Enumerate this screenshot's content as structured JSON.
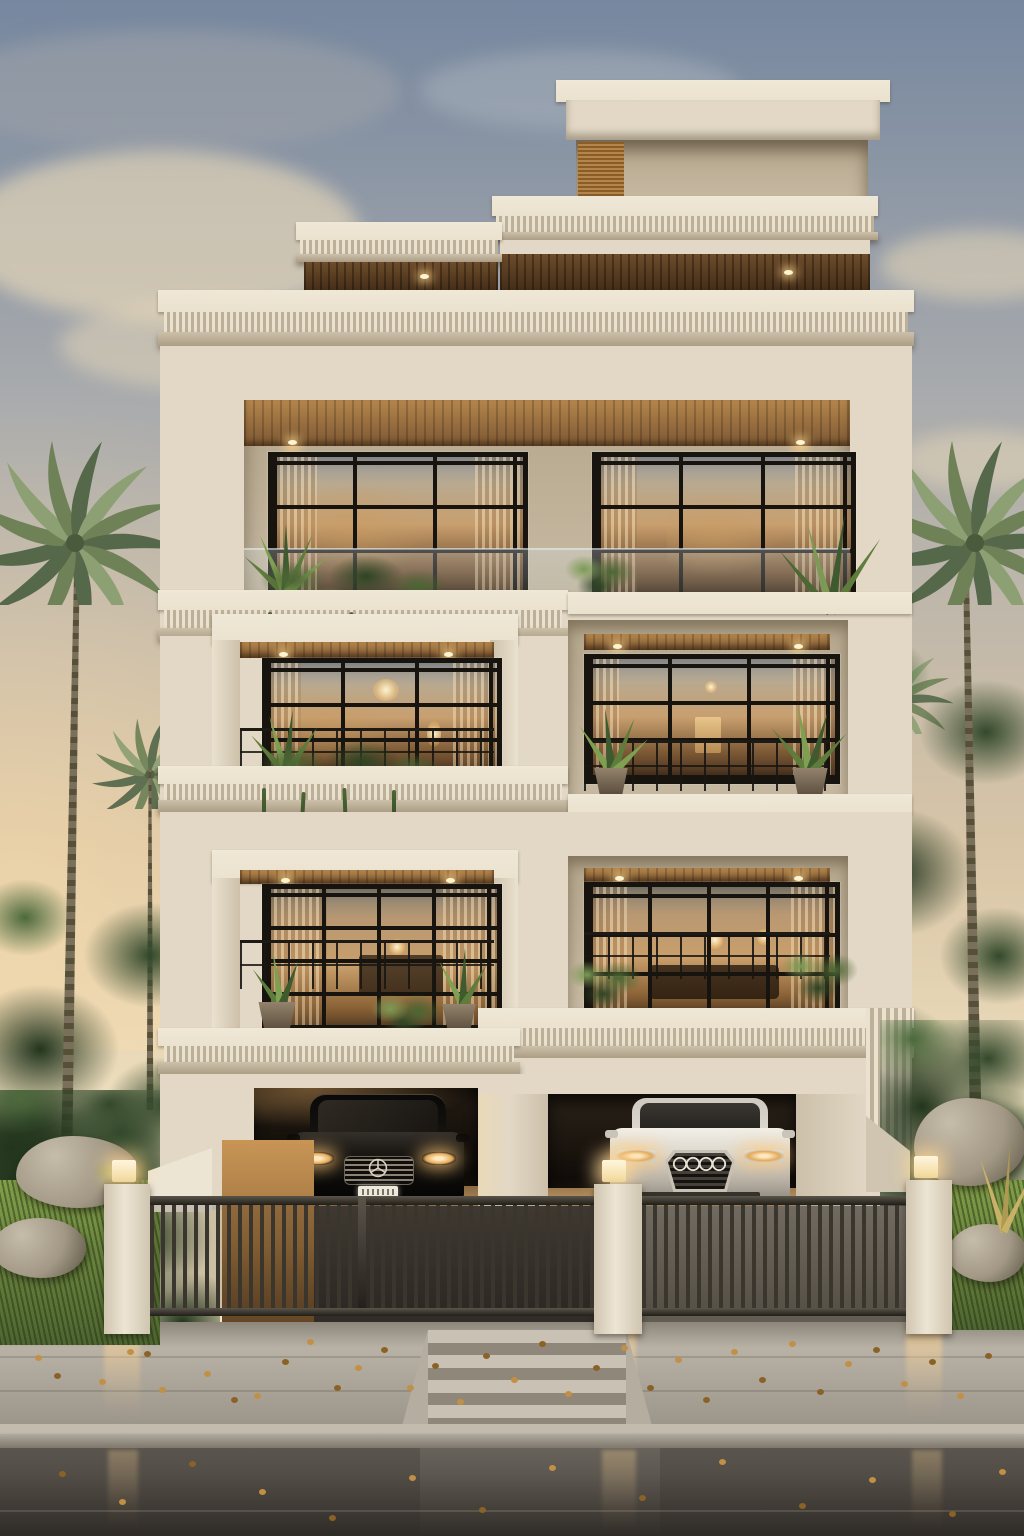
{
  "scene": {
    "type": "architectural exterior rendering",
    "subject": "three-storey modern classical villa",
    "time_of_day": "dusk",
    "weather": "wet after rain",
    "setting": "tropical street lined with palm trees"
  },
  "palette": {
    "skyTop": "#76879F",
    "skyUpper": "#A9ABAD",
    "skyWarm": "#D8C5A7",
    "skyHorizon": "#F5E7C5",
    "cloudWarm": "#F0DDBA",
    "cloudGrey": "#9FA3A8",
    "facade": "#E2D8C5",
    "facadeLight": "#F0E8D7",
    "facadeShade": "#CCC0AA",
    "facadeDark": "#AC9E85",
    "recess": "#C8BBA3",
    "recessDim": "#B5A78D",
    "corniceLight": "#EAE1CE",
    "corniceShade": "#BDB098",
    "wood": "#7C5833",
    "woodDark": "#553A20",
    "woodGold": "#B5864C",
    "frame": "#17140F",
    "glassTop": "#9FA1A2",
    "glassWarm": "#C89F6F",
    "glassDeep": "#7C5935",
    "glassDark": "#452F1D",
    "glow": "#FFD9A2",
    "lamp": "#FFF3D0",
    "plantDark": "#2E4424",
    "plant": "#4C6634",
    "plantLight": "#7C9A55",
    "palm": "#6F8257",
    "palmDark": "#55684A",
    "palmLight": "#8DA073",
    "trunk": "#7A6F5A",
    "trunkDark": "#575039",
    "jungle": "#33492B",
    "jungleLight": "#4C6A3C",
    "jungleDark": "#22351D",
    "rockLight": "#C6BCAA",
    "rock": "#A29885",
    "rockDark": "#665E4E",
    "grass": "#4E6530",
    "grassLit": "#83A04A",
    "fence": "#3A362E",
    "fenceDark": "#211E19",
    "fenceLight": "#5A554B",
    "pillar": "#EDE5D4",
    "pillarShade": "#CFC5B0",
    "pave": "#9C958A",
    "paveLight": "#C2BBAE",
    "paveWarm": "#C8A873",
    "curb": "#B0A99D",
    "road": "#524D46",
    "roadDark": "#2F2B27",
    "leafGold": "#C29044",
    "leafBrown": "#8A6228",
    "carBlack": "#16130F",
    "carWhite": "#E9E5DC",
    "chrome": "#CDC3B0"
  },
  "building": {
    "storeys_visible": 3,
    "facade_finish": "cream stucco with fluted classical cornices",
    "rooftop": {
      "structure": "stair bulkhead with golden wood louvre screen",
      "parapet_levels": 2,
      "soffit": "dark wood slats",
      "downlights": 2
    },
    "floors": [
      {
        "name": "top-floor",
        "windows": 2,
        "window_style": "black steel grid",
        "balcony": "full-width recessed balcony",
        "railing": "frameless glass",
        "ceiling": "warm wood plank soffit",
        "downlights": 2,
        "plants": [
          "potted agave",
          "trailing vine over ledge",
          "small potted plant",
          "tall agave"
        ]
      },
      {
        "name": "middle-floor",
        "bays": 2,
        "windows": 2,
        "railing": "black metal juliet",
        "downlights": 4,
        "interior_details": [
          "crystal chandelier",
          "floor lamp",
          "pendant light"
        ],
        "plants": [
          "potted agave",
          "trailing vine",
          "two potted agaves on right balcony"
        ]
      },
      {
        "name": "ground-floor",
        "bays": 2,
        "windows": 2,
        "railing": "black metal juliet",
        "downlights": 4,
        "interior_details": [
          "desk with lamp",
          "pair of table lamps",
          "sofa silhouettes"
        ],
        "plants": [
          "potted agaves",
          "fern",
          "corner shrubs"
        ]
      }
    ],
    "garage": {
      "bays": 2,
      "lighting": "warm concealed",
      "floor": "polished warm marble"
    }
  },
  "vehicles": [
    {
      "name": "black-sedan",
      "brand": "Mercedes-Benz",
      "badge": "three-pointed star",
      "color_hex": "#16130F",
      "headlights": "on",
      "license_plate": "illegible white plate"
    },
    {
      "name": "white-sedan",
      "brand": "Audi",
      "badge": "four rings",
      "color_hex": "#E9E5DC",
      "headlights": "on"
    }
  ],
  "boundary": {
    "pillars": 3,
    "pillar_lamps": 3,
    "lamp_state": "lit",
    "gates": 2,
    "gate_style": "dark vertical slat metal",
    "left_drive": "warm lit ramp",
    "right_drive": "concrete ramp"
  },
  "landscape": {
    "foreground_palms": 2,
    "background_palms": 2,
    "background": "dense tropical foliage both sides",
    "rocks_left": 2,
    "rocks_right": 2,
    "grass": "lawn patches flanking gates",
    "accent": "backlit agave on right"
  },
  "ground": {
    "forecourt": "wet light stone paving",
    "steps": 4,
    "kerb": "stone kerb",
    "road": "wet asphalt with reflections",
    "fallen_leaves": "scattered golden leaves on paving and road"
  },
  "lighting": {
    "sky": "sunset glow left, cool blue above",
    "interiors": "warm lamplight in all windows",
    "reflections": "lamp glow mirrored on wet ground"
  }
}
